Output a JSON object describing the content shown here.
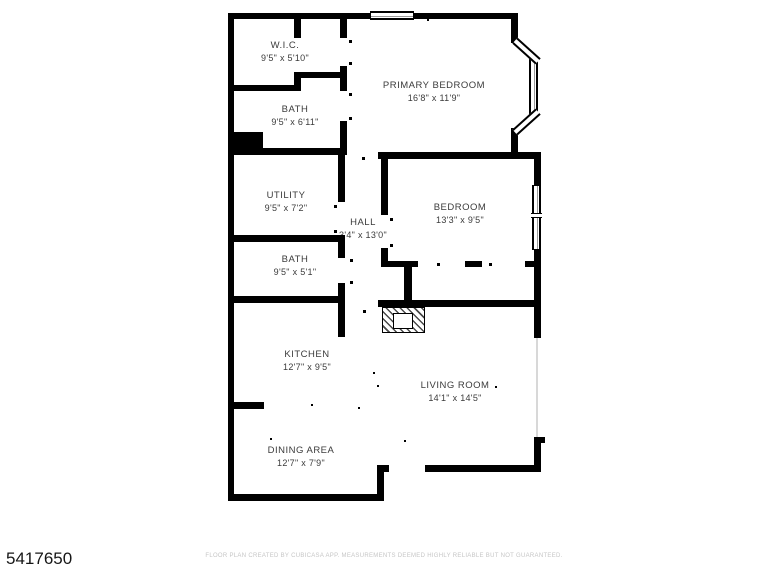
{
  "plan": {
    "rooms": {
      "wic": {
        "name": "W.I.C.",
        "dims": "9'5\" x 5'10\""
      },
      "bath1": {
        "name": "BATH",
        "dims": "9'5\" x 6'11\""
      },
      "primary_bedroom": {
        "name": "PRIMARY BEDROOM",
        "dims": "16'8\" x 11'9\""
      },
      "utility": {
        "name": "UTILITY",
        "dims": "9'5\" x 7'2\""
      },
      "hall": {
        "name": "HALL",
        "dims": "3'4\" x 13'0\""
      },
      "bedroom": {
        "name": "BEDROOM",
        "dims": "13'3\" x 9'5\""
      },
      "bath2": {
        "name": "BATH",
        "dims": "9'5\" x 5'1\""
      },
      "kitchen": {
        "name": "KITCHEN",
        "dims": "12'7\" x 9'5\""
      },
      "living_room": {
        "name": "LIVING ROOM",
        "dims": "14'1\" x 14'5\""
      },
      "dining_area": {
        "name": "DINING AREA",
        "dims": "12'7\" x 7'9\""
      }
    }
  },
  "listing_id": "5417650",
  "footer": {
    "disclaimer": "FLOOR PLAN CREATED BY CUBICASA APP. MEASUREMENTS DEEMED HIGHLY RELIABLE BUT NOT GUARANTEED."
  },
  "colors": {
    "wall": "#000000",
    "background": "#ffffff",
    "label_text": "#3b3b3b",
    "footer_text": "#c6c6c6"
  }
}
